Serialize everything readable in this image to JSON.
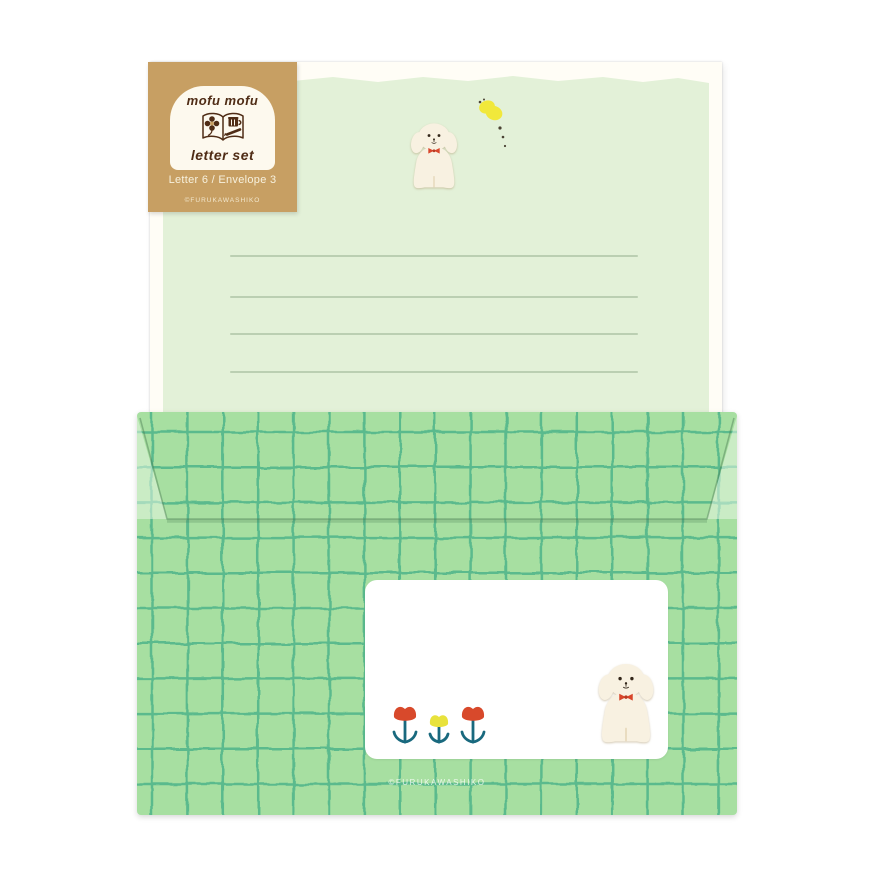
{
  "tag": {
    "brand": "mofu mofu",
    "product": "letter set",
    "contents": "Letter 6 / Envelope 3",
    "copyright": "©FURUKAWASHIKO",
    "icon": "open-book-with-flower-and-cup-icon",
    "colors": {
      "kraft": "#c79f63",
      "ink": "#4f2c15",
      "window": "#fdf9ee"
    }
  },
  "letter_paper": {
    "print_color": "#e3f1d8",
    "sheet_color": "#fffdf6",
    "ruled_line_count": 4,
    "illustrations": [
      "white-dog-with-red-bow-icon",
      "yellow-butterfly-icon"
    ]
  },
  "envelope": {
    "base_color": "#a7dfa1",
    "grid_color": "#52b68b",
    "label_color": "#ffffff",
    "copyright": "©FURUKAWASHIKO",
    "illustrations": [
      "red-tulip-icon",
      "yellow-tulip-icon",
      "red-tulip-icon",
      "white-dog-with-red-bow-icon"
    ]
  },
  "palette": {
    "dog_cream": "#f8f1e1",
    "bow_red": "#d8462b",
    "butterfly_yellow": "#f1e83b",
    "stem_teal": "#19697e"
  }
}
